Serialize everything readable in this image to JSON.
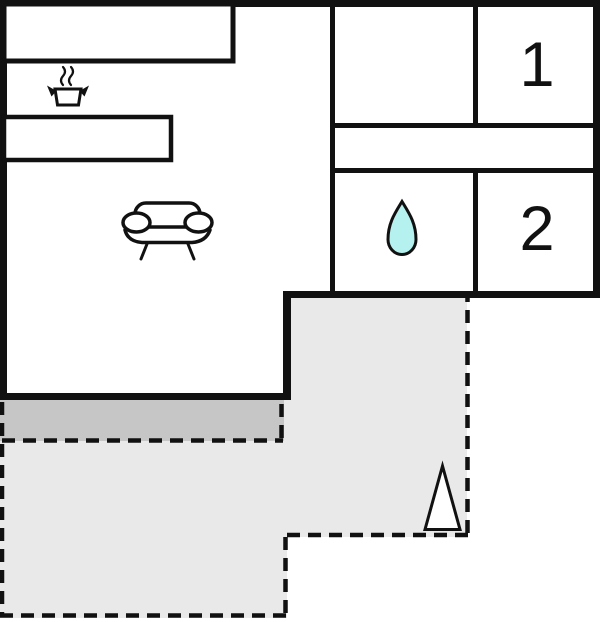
{
  "floorplan": {
    "type": "floor-plan",
    "rooms": {
      "bedroom_1": {
        "label": "1"
      },
      "bedroom_2": {
        "label": "2"
      }
    },
    "icons": {
      "kitchen": "cooking-pot-icon",
      "living_room": "sofa-icon",
      "bathroom": "water-drop-icon",
      "terrace": "north-arrow-icon"
    },
    "colors": {
      "wall": "#111111",
      "background": "#ffffff",
      "water_drop_fill": "#b5f1ee",
      "terrace_fill": "#e9e9e9",
      "terrace_step_fill": "#c6c6c6"
    }
  }
}
